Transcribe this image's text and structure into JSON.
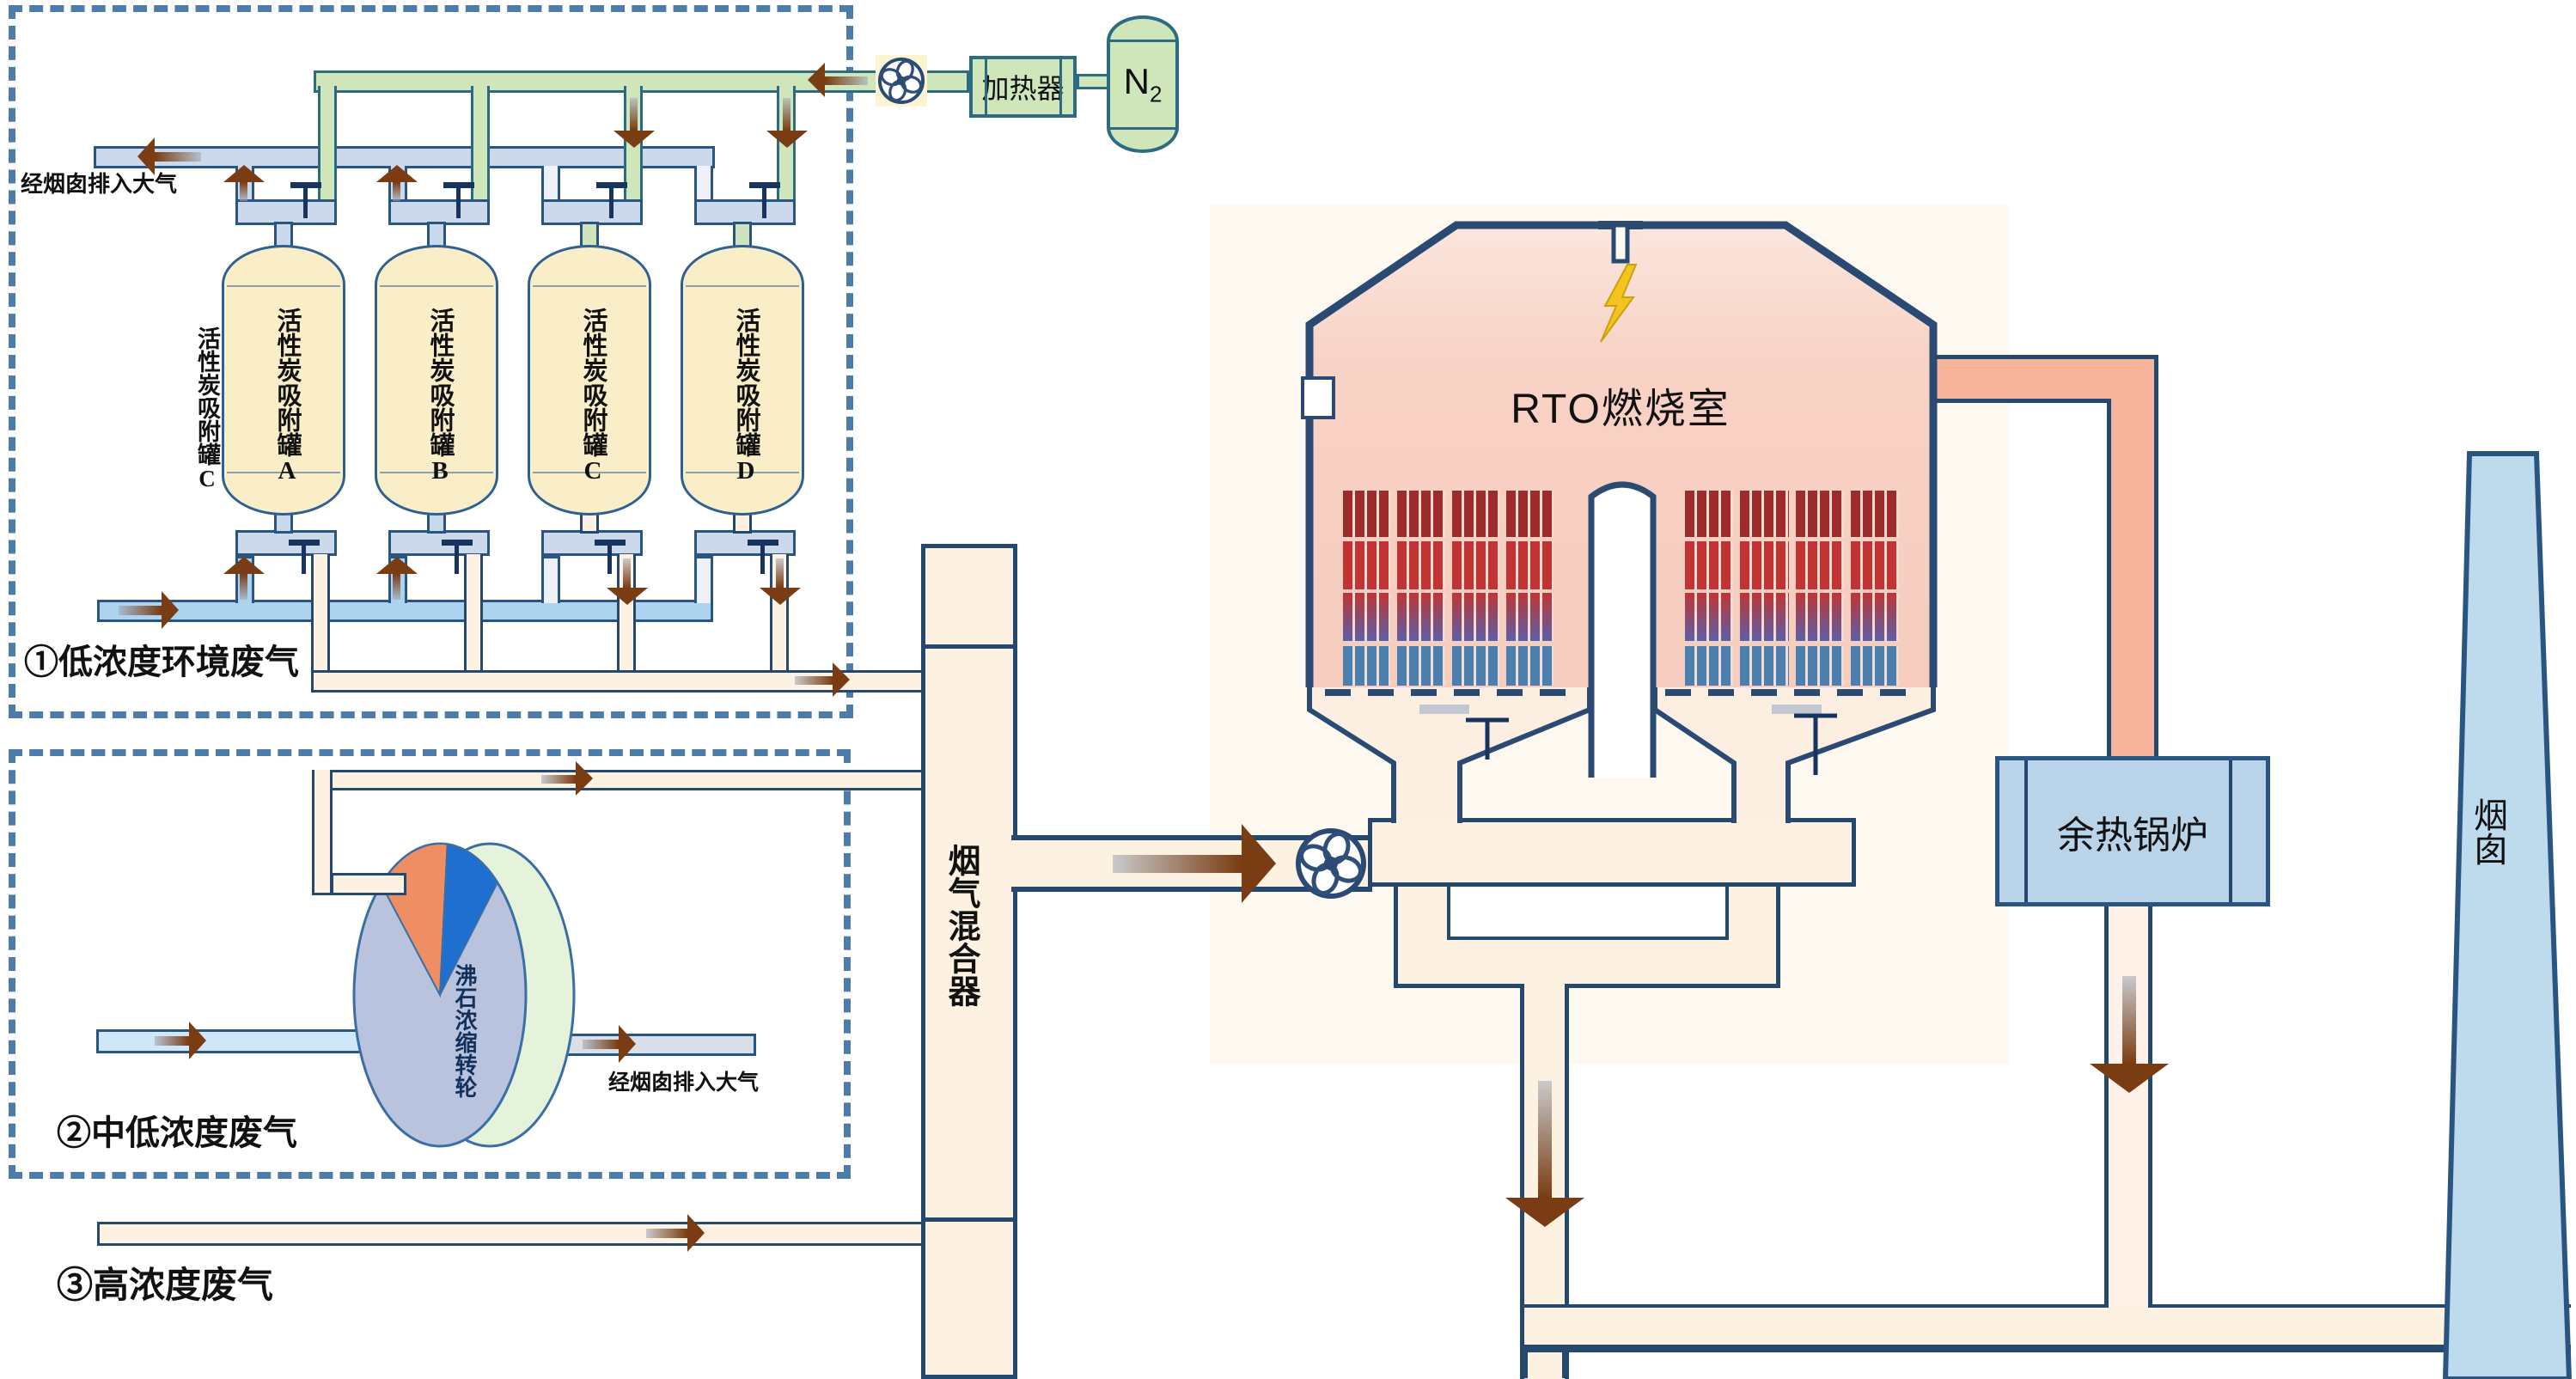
{
  "labels": {
    "exhaust_note_top": "经烟囱排入大气",
    "exhaust_note_wheel": "经烟囱排入大气",
    "stream1": "①低浓度环境废气",
    "stream2": "②中低浓度废气",
    "stream3": "③高浓度废气"
  },
  "tanks": {
    "side_label": "活性炭吸附罐C",
    "items": [
      {
        "label": "活性炭吸附罐A"
      },
      {
        "label": "活性炭吸附罐B"
      },
      {
        "label": "活性炭吸附罐C"
      },
      {
        "label": "活性炭吸附罐D"
      }
    ]
  },
  "wheel": {
    "label": "沸石浓缩转轮"
  },
  "mixer": {
    "label": "烟气混合器"
  },
  "heater": {
    "label": "加热器"
  },
  "n2": {
    "base": "N",
    "sub": "2"
  },
  "rto": {
    "label": "RTO燃烧室"
  },
  "boiler": {
    "label": "余热锅炉"
  },
  "chimney": {
    "label": "烟囱"
  },
  "colors": {
    "pipe_border": "#2a5580",
    "green_pipe": "#cfe6bb",
    "waste_gas_blue": "#add3ee",
    "exhaust_gray": "#ccd9ea",
    "cream_pipe": "#fdf2e2",
    "hot_gas_salmon": "#f7b49c",
    "chamber_pink": "#f8d2c6",
    "boiler_blue": "#b9d4e9",
    "chimney_blue": "#bedbed",
    "flow_arrow_brown": "#7a3c12",
    "lightning_yellow": "#f3c41d"
  },
  "ceramic_rows": [
    {
      "color": "#9e2b2b"
    },
    {
      "color": "#c23434"
    },
    {
      "gradient": [
        "#c23434",
        "#5a5fa8"
      ]
    },
    {
      "color": "#4a7fae"
    }
  ]
}
